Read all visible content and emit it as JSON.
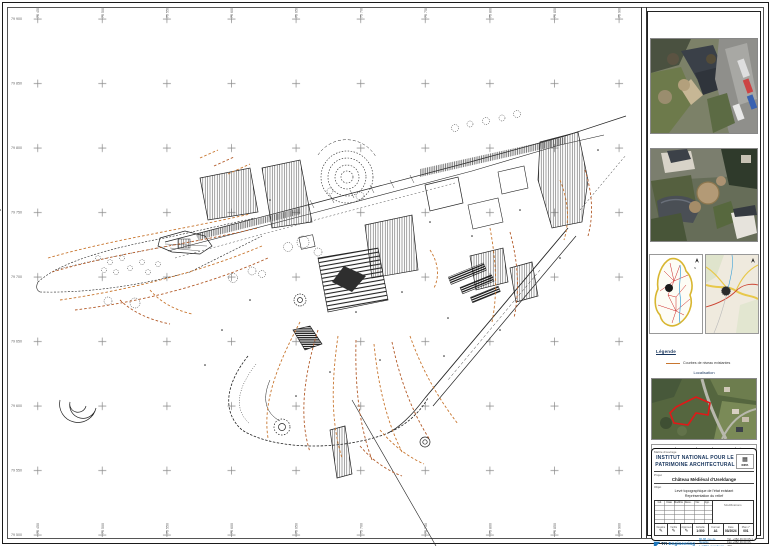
{
  "colors": {
    "contour_orange": "#c8762f",
    "contour_brown": "#b25a28",
    "titleblock_blue": "#17345c",
    "tr_engineering_blue": "#1b75bb",
    "site_boundary_red": "#e01818"
  },
  "grid": {
    "row_labels": [
      "79 900",
      "79 850",
      "79 800",
      "79 750",
      "79 700",
      "79 650",
      "79 600",
      "79 550",
      "79 500"
    ],
    "col_labels": [
      "75 450",
      "75 500",
      "75 550",
      "75 600",
      "75 650",
      "75 700",
      "75 750",
      "75 800",
      "75 850",
      "75 900"
    ]
  },
  "sidebar": {
    "legend": {
      "title": "Légende",
      "item_contours": "Courbes de niveau existantes"
    },
    "localisation_label": "Localisation",
    "credits": {
      "seg1": "Fond de plan",
      "seg2": "orthophoto",
      "seg3": "1:2500",
      "seg4": "geoportail.lu",
      "seg5": "© Administration du cadastre et de la topographie"
    }
  },
  "titleblock": {
    "client_label": "Maître d'ouvrage",
    "client_line1": "INSTITUT NATIONAL POUR LE",
    "client_line2": "PATRIMOINE ARCHITECTURAL",
    "logo_glyph": "▦",
    "logo_text": "INPA",
    "project_label": "Projet",
    "project": "Château Médiéval d'Useldange",
    "object_label": "Objet",
    "object_line1": "Levé topographique de l'état existant",
    "object_line2": "Représentation du relief",
    "rev_headers": [
      "Ind.",
      "Date",
      "Modification",
      "Dess.",
      "Vér.",
      "App."
    ],
    "rev_note": "Modifications",
    "sign_labels": [
      "Dessiné",
      "Vérifié",
      "Approuvé"
    ],
    "pen_icon": "✎",
    "fields": [
      {
        "label": "Echelle",
        "value": "1:500"
      },
      {
        "label": "Format",
        "value": "A1"
      },
      {
        "label": "Date",
        "value": "03/2024"
      },
      {
        "label": "Plan n°",
        "value": "001"
      }
    ],
    "firm": {
      "mark": "◤",
      "name_strong": "TR",
      "name_light": " Engineering",
      "tagline": "Ingénieurs-conseils en génie civil",
      "addr1": "86-88, rue de l'Égalité",
      "addr2": "L-1456 Luxembourg",
      "addr3": "www.tr-engineering.lu",
      "contact1": "Tél. +352 49 00 65-1",
      "contact2": "Fax +352 49 00 65-299",
      "contact3": "info@tr-engineering.lu"
    }
  }
}
